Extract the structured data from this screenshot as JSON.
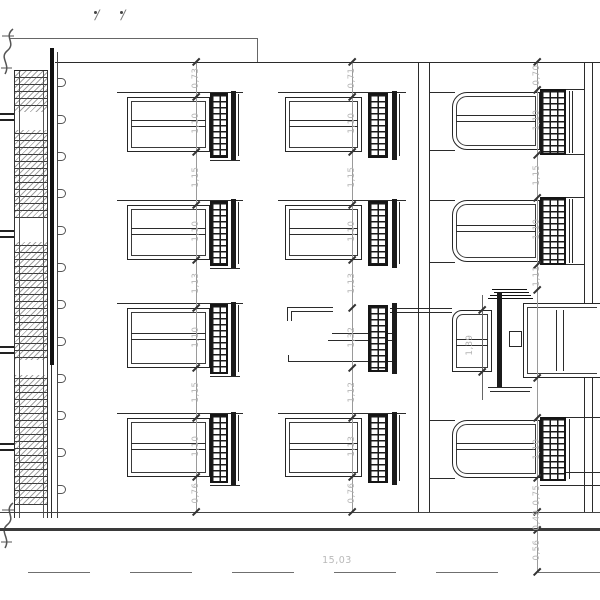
{
  "drawing": {
    "type": "architectural-elevation",
    "markers": [
      "∕",
      "∕"
    ]
  },
  "dims": {
    "line1": [
      "0,73",
      "1,10",
      "1,15",
      "1,10",
      "1,13",
      "1,10",
      "1,15",
      "1,10",
      "0,76"
    ],
    "line2": [
      "0,71",
      "1,10",
      "1,15",
      "1,10",
      "1,13",
      "1,32",
      "1,12",
      "1,13",
      "0,76"
    ],
    "line3": [
      "0,70",
      "1,10",
      "1,15",
      "1,10",
      "1,11",
      "1,10",
      "0,75",
      "0,49",
      "0,56"
    ],
    "door": "1,39",
    "overall": "15,03"
  },
  "colors": {
    "ink": "#2b2b2b",
    "dim_line": "#9a9a9a",
    "dim_text": "#b4b4b4",
    "ground": "#3a3a3a"
  }
}
